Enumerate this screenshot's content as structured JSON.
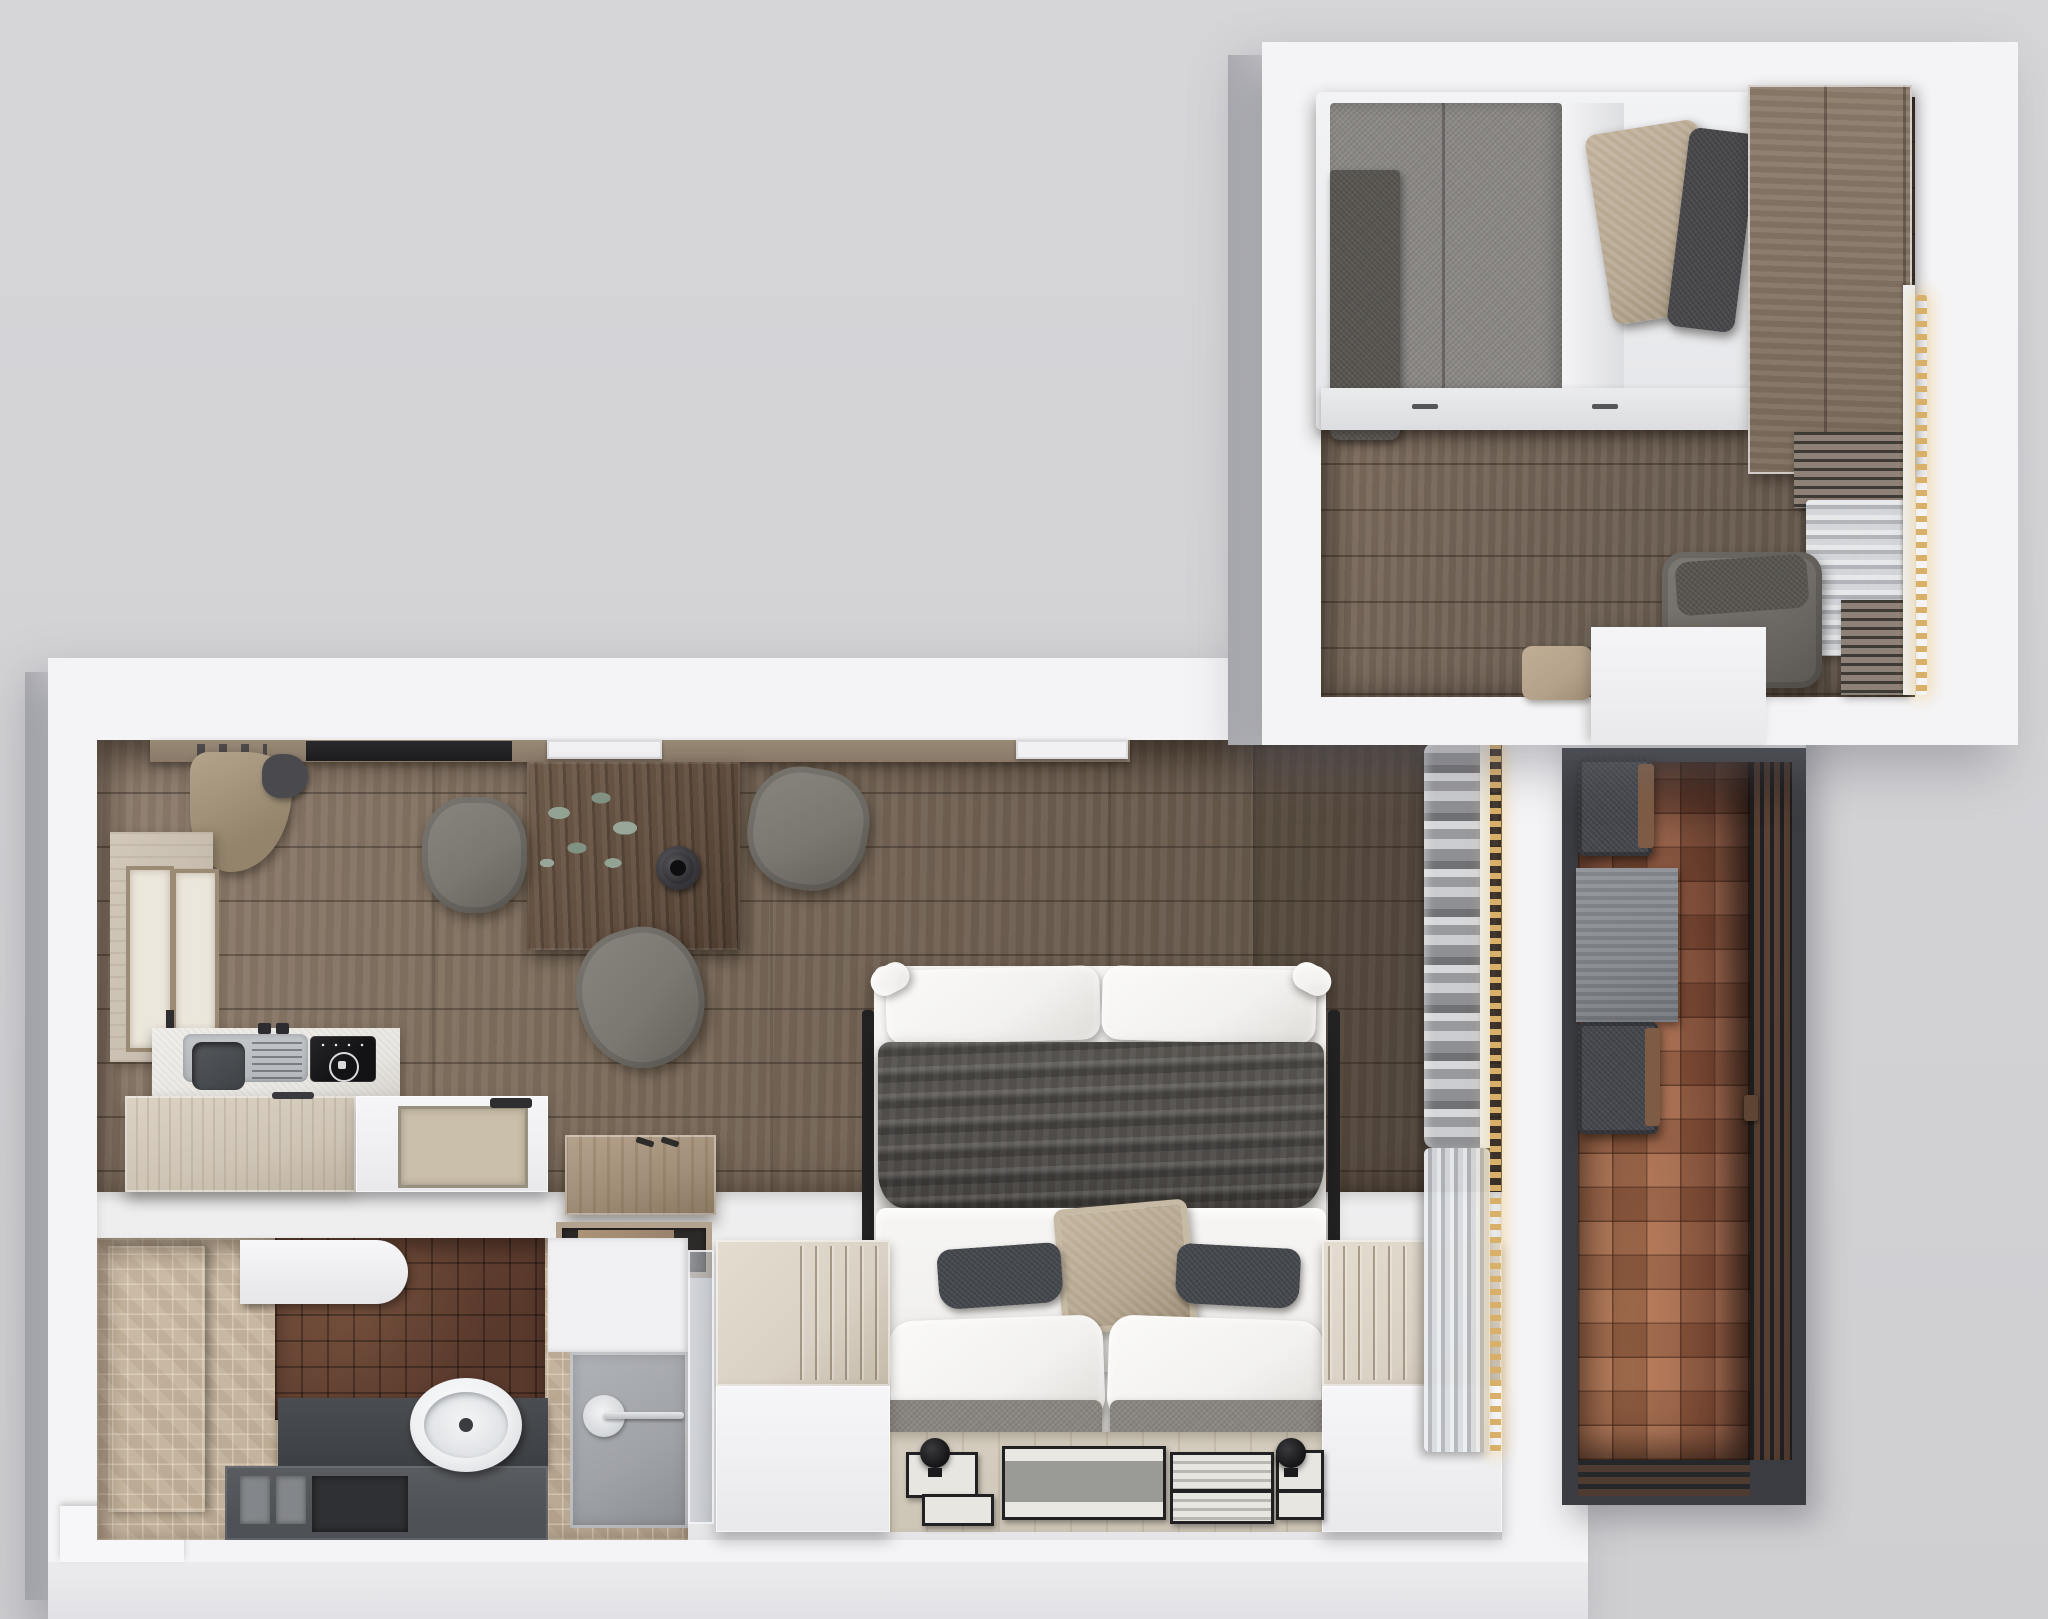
{
  "scene": {
    "kind": "3d-floorplan-top-down-render",
    "canvas": {
      "width": 2048,
      "height": 1619
    },
    "rooms_count": 4
  },
  "palette": {
    "bg-top": "#d6d6d9",
    "bg-bot": "#cfcfd2",
    "wall": "#f4f4f6",
    "wall-face": "#bcbcc1",
    "floor-light": "#8e7d6d",
    "floor-dark": "#5c5045",
    "floor-up-light": "#837263",
    "floor-up-dark": "#5f5348",
    "wardrobe": "#8d7c6c",
    "table-wood": "#5f4c3d",
    "island": "#cfc5b6",
    "panel-wood": "#c8beb0",
    "shelf-wood": "#8a7969",
    "counter": "#e9e7e3",
    "sink-metal": "#b3b7bb",
    "basin": "#3f4246",
    "cooktop": "#131315",
    "stool-wood": "#a08d77",
    "tray-beige": "#cabfab",
    "blanket": "#4d4a47",
    "duvet": "#f2f1ef",
    "pillow-beige": "#b2a38c",
    "pillow-dark": "#43464b",
    "cushion-tweed": "#8b8680",
    "bench": "#d9d1c4",
    "gallery-floor": "#cdc5b6",
    "frame-black": "#212124",
    "frame-inner": "#e8e6e1",
    "linen-gray": "#96979b",
    "curtain": "#dcdde0",
    "gold": "#d9b069",
    "tile-brown": "#59392c",
    "mosaic": "#c3b29c",
    "dark-panel": "#5b5d62",
    "vanity": "#4e5155",
    "console": "#3c3f43",
    "shower-gray": "#9fa2a7",
    "balcony-tile": "#94583f",
    "balcony-frame": "#3a3c41",
    "chair-dark": "#43454b",
    "mat-gray": "#83878c",
    "chair-gray": "#7b7771",
    "coat-beige": "#b4a48c"
  },
  "rooms": [
    {
      "id": "bedroom",
      "label": "bedroom with single bed, wardrobe and lounge chair",
      "furniture": [
        "single bed",
        "gray duvet",
        "white sheet",
        "dark throw blanket",
        "patterned beige pillow",
        "dark gray pillow",
        "wardrobe",
        "louver vent",
        "sheer curtain",
        "warm light strip",
        "lounge chair",
        "floor pouf",
        "door step"
      ]
    },
    {
      "id": "studio",
      "label": "main studio room with kitchen, dining table and sofa bed",
      "furniture": [
        "wall shelf with tv panel",
        "hanging coat",
        "dining table",
        "plant",
        "vase",
        "three gray chairs",
        "wall panel with two frames",
        "kitchen counter",
        "sink",
        "induction cooktop",
        "kitchen island",
        "serving tray",
        "wooden stool",
        "floor tray",
        "sofa bed",
        "gray rumpled blanket",
        "white duvet",
        "beige accent pillow",
        "two dark lumbar pillows",
        "two white pillows",
        "two seat cushions",
        "storage bench left",
        "storage bench right",
        "two round floor lamps",
        "seven picture frames on gallery floor",
        "folded linen shelf",
        "sheer curtain wall",
        "warm light strip",
        "glass door"
      ]
    },
    {
      "id": "bathroom",
      "label": "bathroom with vanity sink and shower",
      "furniture": [
        "dark glass panel",
        "wall cabinet",
        "brown tile wall",
        "mosaic floor",
        "dark vanity with compartments",
        "oval sink",
        "shower tray",
        "shower drain",
        "towel bar"
      ]
    },
    {
      "id": "balcony",
      "label": "balcony with terracotta tiles, two chairs and mat",
      "furniture": [
        "terracotta checker floor",
        "slatted railing door",
        "lounge chair upper",
        "lounge chair lower",
        "gray mat",
        "door handle"
      ]
    }
  ]
}
